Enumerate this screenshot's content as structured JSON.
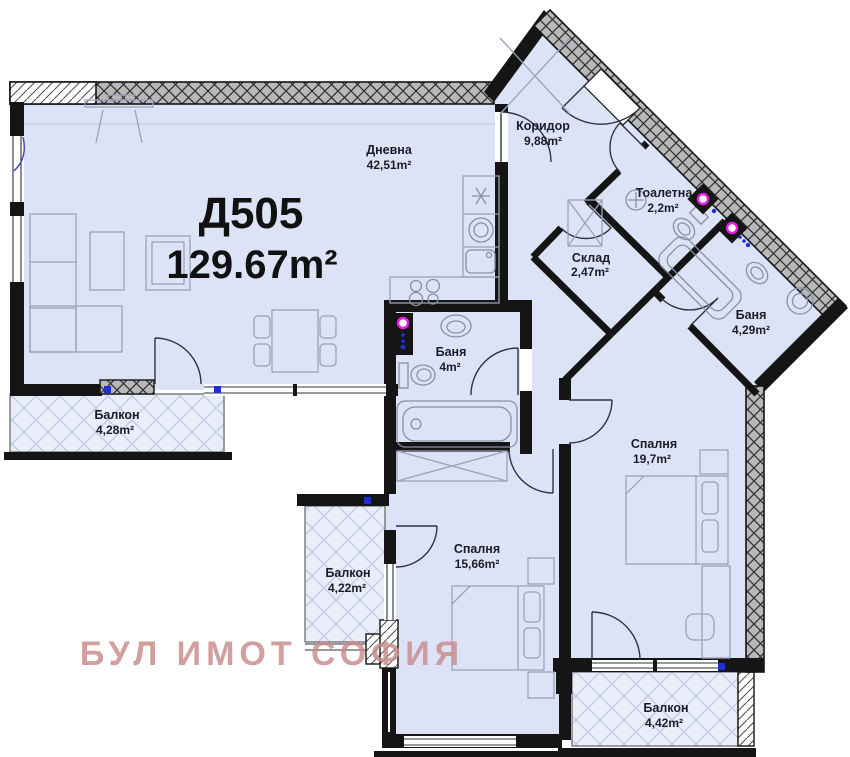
{
  "plan": {
    "unit_id": "Д505",
    "total_area": "129.67m²"
  },
  "rooms": [
    {
      "name": "Дневна",
      "area": "42,51m²"
    },
    {
      "name": "Коридор",
      "area": "9,88m²"
    },
    {
      "name": "Тоалетна",
      "area": "2,2m²"
    },
    {
      "name": "Склад",
      "area": "2,47m²"
    },
    {
      "name": "Баня",
      "area": "4m²"
    },
    {
      "name": "Баня",
      "area": "4,29m²"
    },
    {
      "name": "Спалня",
      "area": "19,7m²"
    },
    {
      "name": "Спалня",
      "area": "15,66m²"
    },
    {
      "name": "Балкон",
      "area": "4,28m²"
    },
    {
      "name": "Балкон",
      "area": "4,22m²"
    },
    {
      "name": "Балкон",
      "area": "4,42m²"
    }
  ],
  "watermark": {
    "text": "БУЛ ИМОТ СОФИЯ"
  },
  "colors": {
    "room_fill": "#dde3f6",
    "wall": "#151515",
    "exterior_hatch": "#b8b8b8",
    "balcony_lattice": "#c2cbe4",
    "watermark": "#c98a8a",
    "shaft_magenta": "#ec1bec",
    "marker_blue": "#1b2fd4"
  }
}
